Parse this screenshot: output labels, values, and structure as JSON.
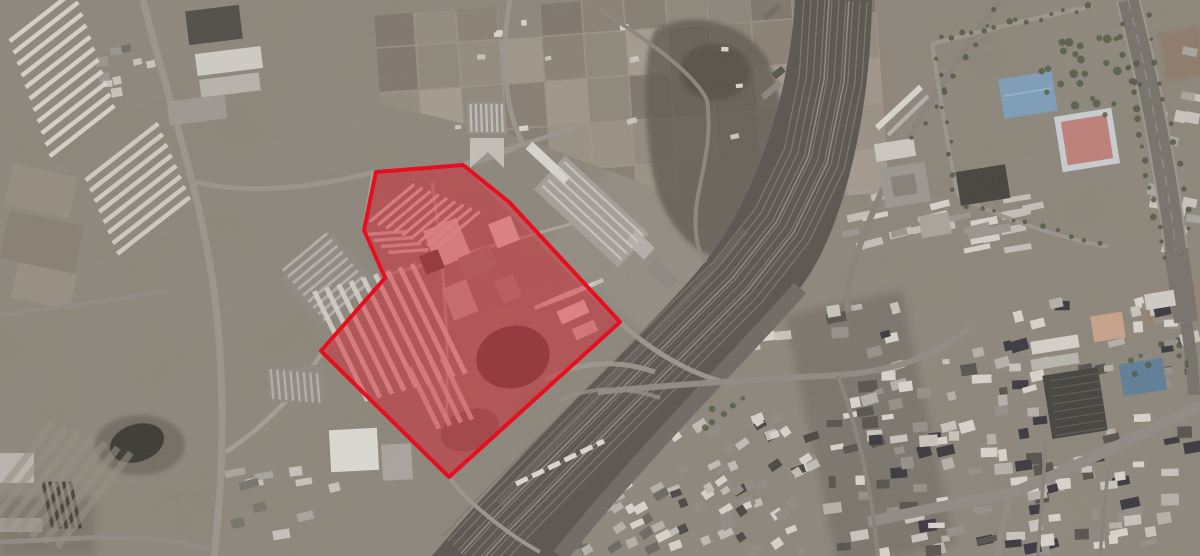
{
  "canvas": {
    "width": 1200,
    "height": 556
  },
  "annotation": {
    "label": "highlighted-area",
    "points": "376,172 463,165 509,202 620,322 449,477 321,351 385,278 364,230",
    "fill": "rgba(223,18,38,0.42)",
    "stroke": "#e50f1f",
    "stroke_width": 4
  },
  "palette": {
    "terrain_base": "#8b8479",
    "railway_band": "#59544f",
    "road": "#9a948c",
    "highway": "#76716b",
    "blue_roof": "#7d9db8",
    "blue_roof_2": "#5e7e97",
    "sports_court": "#bd7f78",
    "parking_lot": "#45433f",
    "pond": "#3c3a35",
    "tan_roof": "#c7a28a",
    "building_light": "#d8d4cd",
    "building_mid": "#b5b1aa",
    "building_dark": "#56534e",
    "tree": "#4f5740"
  },
  "scene": {
    "clusters": [
      {
        "name": "urban-bottom-right",
        "x": 832,
        "y": 302,
        "w": 365,
        "h": 252,
        "count": 175,
        "angle": -9,
        "angle_jitter": 16,
        "min_w": 7,
        "max_w": 20,
        "min_h": 5,
        "max_h": 12,
        "colors": [
          "#d8d4cd",
          "#b5b1aa",
          "#948f88",
          "#56534e",
          "#3a383f",
          "#c8c4bd"
        ],
        "seed": 7
      },
      {
        "name": "urban-right-rows",
        "x": 845,
        "y": 196,
        "w": 195,
        "h": 55,
        "count": 26,
        "angle": -12,
        "angle_jitter": 6,
        "min_w": 16,
        "max_w": 30,
        "min_h": 5,
        "max_h": 8,
        "colors": [
          "#d6d2cb",
          "#c3bfb8",
          "#9a958e"
        ],
        "seed": 3
      },
      {
        "name": "village-bottom-center",
        "x": 662,
        "y": 418,
        "w": 152,
        "h": 136,
        "count": 60,
        "angle": -28,
        "angle_jitter": 18,
        "min_w": 8,
        "max_w": 16,
        "min_h": 6,
        "max_h": 10,
        "colors": [
          "#d6d2cb",
          "#c0bcb5",
          "#8f8a83",
          "#4a4742"
        ],
        "seed": 11
      },
      {
        "name": "row-houses-mid",
        "x": 640,
        "y": 328,
        "w": 150,
        "h": 26,
        "count": 13,
        "angle": -6,
        "angle_jitter": 5,
        "min_w": 12,
        "max_w": 20,
        "min_h": 7,
        "max_h": 9,
        "colors": [
          "#d8d4cd",
          "#c8c4bd"
        ],
        "seed": 5
      },
      {
        "name": "urban-bottom-center",
        "x": 556,
        "y": 486,
        "w": 110,
        "h": 68,
        "count": 24,
        "angle": -30,
        "angle_jitter": 12,
        "min_w": 8,
        "max_w": 15,
        "min_h": 6,
        "max_h": 9,
        "colors": [
          "#d8d4cd",
          "#b5b1aa",
          "#6b6862"
        ],
        "seed": 9
      },
      {
        "name": "smallbuildings-topleft",
        "x": 95,
        "y": 42,
        "w": 75,
        "h": 55,
        "count": 9,
        "angle": -8,
        "angle_jitter": 10,
        "min_w": 8,
        "max_w": 16,
        "min_h": 6,
        "max_h": 10,
        "colors": [
          "#c8c4bd",
          "#9a958e",
          "#6f6b65"
        ],
        "seed": 13
      },
      {
        "name": "sheds-left-mid",
        "x": 228,
        "y": 468,
        "w": 112,
        "h": 72,
        "count": 11,
        "angle": -12,
        "angle_jitter": 10,
        "min_w": 10,
        "max_w": 22,
        "min_h": 6,
        "max_h": 10,
        "colors": [
          "#c6c2bb",
          "#a8a49d",
          "#77736d"
        ],
        "seed": 17
      },
      {
        "name": "buildings-east-highway",
        "x": 1152,
        "y": 40,
        "w": 46,
        "h": 225,
        "count": 14,
        "angle": 12,
        "angle_jitter": 10,
        "min_w": 10,
        "max_w": 20,
        "min_h": 7,
        "max_h": 12,
        "colors": [
          "#c8c4bd",
          "#a8a49d",
          "#8a867f"
        ],
        "seed": 21
      },
      {
        "name": "railyard-structures",
        "x": 766,
        "y": 6,
        "w": 66,
        "h": 85,
        "count": 7,
        "angle": -38,
        "angle_jitter": 6,
        "min_w": 10,
        "max_w": 26,
        "min_h": 5,
        "max_h": 8,
        "colors": [
          "#6f6b65",
          "#56534e",
          "#8a867f"
        ],
        "seed": 23
      },
      {
        "name": "farm-dots",
        "x": 430,
        "y": 10,
        "w": 330,
        "h": 150,
        "count": 14,
        "angle": -5,
        "angle_jitter": 20,
        "min_w": 5,
        "max_w": 10,
        "min_h": 4,
        "max_h": 7,
        "colors": [
          "#d8d4cd",
          "#c8c4bd"
        ],
        "seed": 29
      }
    ],
    "strip_groups": [
      {
        "name": "container-rows-a",
        "cx": 42,
        "cy": 16,
        "sx": 4,
        "sy": 11.5,
        "count": 11,
        "angle": -38,
        "length": 82,
        "width": 4.5,
        "color": "#d9d5ce",
        "opacity": 0.95
      },
      {
        "name": "container-rows-b",
        "cx": 122,
        "cy": 152,
        "sx": 4.5,
        "sy": 10.5,
        "count": 8,
        "angle": -38,
        "length": 92,
        "width": 4.5,
        "color": "#d5d1ca",
        "opacity": 0.9
      },
      {
        "name": "factory-roof-stripes",
        "cx": 305,
        "cy": 252,
        "sx": 5.1,
        "sy": 6.2,
        "count": 9,
        "angle": -40,
        "length": 58,
        "width": 3,
        "color": "#b6b1aa",
        "opacity": 0.9
      },
      {
        "name": "warehouse-stripes-1",
        "cx": 272,
        "cy": 384,
        "sx": 6.6,
        "sy": 0.6,
        "count": 8,
        "angle": 85,
        "length": 30,
        "width": 2.4,
        "color": "#b6b1aa",
        "opacity": 0.9
      },
      {
        "name": "warehouse-stripes-2",
        "cx": 471,
        "cy": 118,
        "sx": 5.2,
        "sy": 0,
        "count": 7,
        "angle": 88,
        "length": 28,
        "width": 2.2,
        "color": "#c6c2bb",
        "opacity": 0.9
      },
      {
        "name": "long-warehouse-ridges",
        "cx": 604,
        "cy": 199,
        "sx": -5.5,
        "sy": 5.9,
        "count": 5,
        "angle": 43,
        "length": 108,
        "width": 2.4,
        "color": "#ccc8c1",
        "opacity": 0.85
      },
      {
        "name": "poly-chevron-rows",
        "cx": 392,
        "cy": 203,
        "sx": 8.2,
        "sy": 3.4,
        "count": 9,
        "angle": -40,
        "length": 58,
        "width": 3.2,
        "color": "#d6d2cb",
        "opacity": 0.92
      },
      {
        "name": "poly-chevron-rows-2",
        "cx": 386,
        "cy": 233,
        "sx": 7.5,
        "sy": 6.0,
        "count": 4,
        "angle": -4,
        "length": 40,
        "width": 3.4,
        "color": "#cfcbc4",
        "opacity": 0.85
      },
      {
        "name": "poly-halls-main",
        "cx": 341,
        "cy": 346,
        "sx": 12.2,
        "sy": -3.4,
        "count": 9,
        "angle": 64,
        "length": 122,
        "width": 5,
        "color": "#d2cec7",
        "opacity": 0.92
      },
      {
        "name": "poly-halls-south",
        "cx": 424,
        "cy": 398,
        "sx": 11,
        "sy": -3,
        "count": 4,
        "angle": 64,
        "length": 68,
        "width": 5,
        "color": "#c9c5be",
        "opacity": 0.9
      },
      {
        "name": "poly-east-strips",
        "cx": 553,
        "cy": 300,
        "sx": 8,
        "sy": -3,
        "count": 5,
        "angle": -24,
        "length": 40,
        "width": 4,
        "color": "#ccc8c1",
        "opacity": 0.9
      },
      {
        "name": "parking-stripes",
        "cx": 1075,
        "cy": 377,
        "sx": 0.9,
        "sy": 7.8,
        "count": 8,
        "angle": -9,
        "length": 50,
        "width": 1.3,
        "color": "#5f5c58",
        "opacity": 0.9
      },
      {
        "name": "lumber-strips",
        "cx": 48,
        "cy": 505,
        "sx": 6.8,
        "sy": 0,
        "count": 5,
        "angle": 78,
        "length": 48,
        "width": 3.5,
        "color": "#3f3c37",
        "opacity": 0.9
      },
      {
        "name": "field-strips-left",
        "cx": 16,
        "cy": 470,
        "sx": 13,
        "sy": 5,
        "count": 7,
        "angle": -52,
        "length": 120,
        "width": 7,
        "color": "#968d82",
        "opacity": 0.6
      }
    ],
    "field_grid": {
      "x0": 378,
      "y0": -12,
      "cols": 12,
      "rows": 5,
      "cell_w": 42,
      "cell_h": 45,
      "colors": [
        "#958c80",
        "#a2998c",
        "#8a8175",
        "#9c9387",
        "#867d72",
        "#90887c",
        "#7d756b",
        "#a89f92"
      ],
      "stroke": "#b3aa9b",
      "seed": 31,
      "skip": 0.12
    },
    "tracks": {
      "points": [
        [
          833,
          0
        ],
        [
          828,
          80
        ],
        [
          812,
          158
        ],
        [
          780,
          224
        ],
        [
          736,
          280
        ],
        [
          662,
          354
        ],
        [
          576,
          440
        ],
        [
          497,
          520
        ],
        [
          464,
          556
        ]
      ],
      "offsets": [
        -34,
        -27,
        -20,
        -13,
        -6,
        1,
        8,
        15,
        22,
        29
      ],
      "color": "#7b766f",
      "width": 1.2,
      "bright_offsets": [
        -16,
        4
      ],
      "bright_color": "#8d8881",
      "bright_width": 1.6
    },
    "tree_rows": [
      {
        "x1": 940,
        "y1": 38,
        "x2": 1085,
        "y2": 8,
        "count": 14,
        "r": 2.6,
        "jitter": 3,
        "seed": 2
      },
      {
        "x1": 1120,
        "y1": 25,
        "x2": 1163,
        "y2": 255,
        "count": 18,
        "r": 2.8,
        "jitter": 3,
        "seed": 4
      },
      {
        "x1": 1149,
        "y1": 18,
        "x2": 1190,
        "y2": 228,
        "count": 11,
        "r": 2.4,
        "jitter": 3,
        "seed": 6
      },
      {
        "x1": 938,
        "y1": 58,
        "x2": 955,
        "y2": 190,
        "count": 9,
        "r": 2.4,
        "jitter": 3,
        "seed": 8
      },
      {
        "x1": 966,
        "y1": 204,
        "x2": 1100,
        "y2": 246,
        "count": 10,
        "r": 2.4,
        "jitter": 3,
        "seed": 10
      },
      {
        "x1": 995,
        "y1": 12,
        "x2": 913,
        "y2": 140,
        "count": 9,
        "r": 2.4,
        "jitter": 3,
        "seed": 12
      }
    ],
    "tree_clusters": [
      {
        "x": 1040,
        "y": 38,
        "w": 100,
        "h": 84,
        "count": 28,
        "rmin": 2,
        "rmax": 4.5,
        "seed": 14
      },
      {
        "x": 1108,
        "y": 336,
        "w": 84,
        "h": 58,
        "count": 9,
        "rmin": 2,
        "rmax": 3.5,
        "seed": 16
      },
      {
        "x": 700,
        "y": 390,
        "w": 60,
        "h": 40,
        "count": 6,
        "rmin": 2,
        "rmax": 4,
        "seed": 18
      }
    ]
  }
}
